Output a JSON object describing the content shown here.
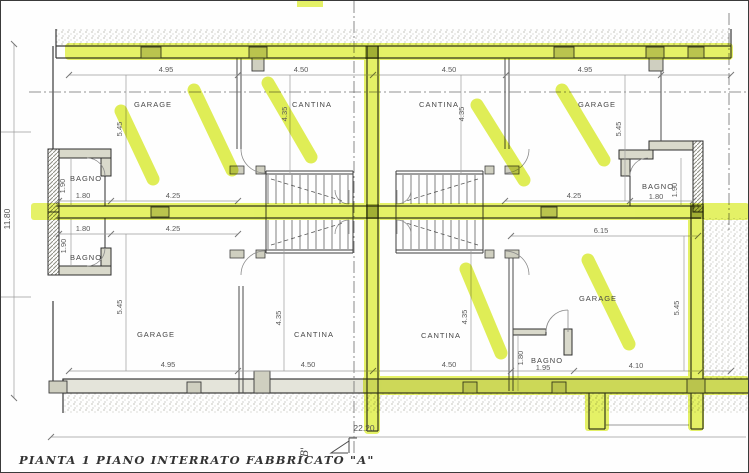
{
  "drawing": {
    "caption": "PIANTA 1 PIANO INTERRATO FABBRICATO \"A\"",
    "section_marker": "B'",
    "overall_width_m": "22.20",
    "overall_depth_m": "11.80"
  },
  "colors": {
    "highlighter": "#e0ef45",
    "highlighter_dark": "#97a52c",
    "ink": "#3d3d3d",
    "dim_line": "#999999",
    "paper": "#fefefe"
  },
  "rooms": [
    {
      "id": "garage-top-left",
      "label": "GARAGE"
    },
    {
      "id": "cantina-top-left",
      "label": "CANTINA"
    },
    {
      "id": "cantina-top-right",
      "label": "CANTINA"
    },
    {
      "id": "garage-top-right",
      "label": "GARAGE"
    },
    {
      "id": "bagno-top-left",
      "label": "BAGNO"
    },
    {
      "id": "bagno-top-right",
      "label": "BAGNO"
    },
    {
      "id": "bagno-bottom-left",
      "label": "BAGNO"
    },
    {
      "id": "garage-bottom-left",
      "label": "GARAGE"
    },
    {
      "id": "cantina-bottom-left",
      "label": "CANTINA"
    },
    {
      "id": "cantina-bottom-right",
      "label": "CANTINA"
    },
    {
      "id": "bagno-bottom-right",
      "label": "BAGNO"
    },
    {
      "id": "garage-bottom-right",
      "label": "GARAGE"
    }
  ],
  "dims": [
    {
      "id": "top-garage-left-width",
      "text": "4.95"
    },
    {
      "id": "top-cantina-left-width",
      "text": "4.50"
    },
    {
      "id": "top-cantina-right-width",
      "text": "4.50"
    },
    {
      "id": "top-garage-right-width",
      "text": "4.95"
    },
    {
      "id": "garage-tl-depth",
      "text": "5.45"
    },
    {
      "id": "cantina-tl-depth",
      "text": "4.35"
    },
    {
      "id": "cantina-tr-depth",
      "text": "4.35"
    },
    {
      "id": "garage-tr-depth",
      "text": "5.45"
    },
    {
      "id": "bagno-tl-depth",
      "text": "1.90"
    },
    {
      "id": "bagno-tl-width",
      "text": "1.80"
    },
    {
      "id": "garage-tl-inner-width",
      "text": "4.25"
    },
    {
      "id": "garage-tr-inner-width",
      "text": "4.25"
    },
    {
      "id": "bagno-tr-depth",
      "text": "1.90"
    },
    {
      "id": "bagno-tr-width",
      "text": "1.80"
    },
    {
      "id": "bagno-bl-width",
      "text": "1.80"
    },
    {
      "id": "garage-bl-inner-width",
      "text": "4.25"
    },
    {
      "id": "unit-br-width",
      "text": "6.15"
    },
    {
      "id": "bagno-bl-depth",
      "text": "1.90"
    },
    {
      "id": "garage-bl-depth",
      "text": "5.45"
    },
    {
      "id": "cantina-bl-depth",
      "text": "4.35"
    },
    {
      "id": "cantina-br-depth",
      "text": "4.35"
    },
    {
      "id": "garage-br-depth",
      "text": "5.45"
    },
    {
      "id": "bagno-br-depth",
      "text": "1.80"
    },
    {
      "id": "bagno-br-width",
      "text": "1.95"
    },
    {
      "id": "garage-br-width",
      "text": "4.10"
    },
    {
      "id": "bottom-garage-left-width",
      "text": "4.95"
    },
    {
      "id": "bottom-cantina-left-width",
      "text": "4.50"
    },
    {
      "id": "bottom-cantina-right-width",
      "text": "4.50"
    },
    {
      "id": "overall-width",
      "text": "22.20"
    },
    {
      "id": "overall-depth",
      "text": "11.80"
    }
  ]
}
